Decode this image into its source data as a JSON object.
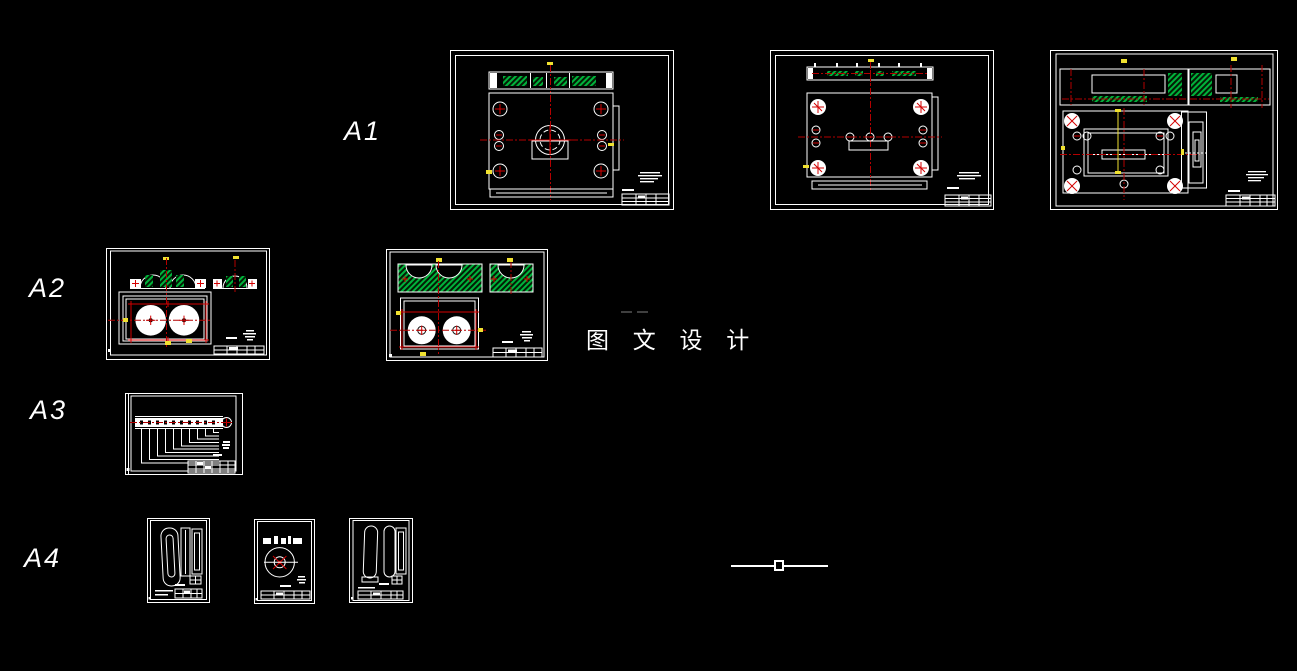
{
  "app": {
    "name": "cad-drawing-workspace",
    "background": "#000000"
  },
  "rows": [
    {
      "label": "A1",
      "sheet_count": 3
    },
    {
      "label": "A2",
      "sheet_count": 2
    },
    {
      "label": "A3",
      "sheet_count": 1
    },
    {
      "label": "A4",
      "sheet_count": 3
    }
  ],
  "watermark": {
    "text": "图 文 设 计"
  },
  "colors": {
    "background": "#000000",
    "paper_line": "#ffffff",
    "hatch_green": "#00b33c",
    "centerline_red": "#b40000",
    "marker_red": "#d40000",
    "dimension_yellow": "#f0e130",
    "faint_gray": "#3f3f3f"
  }
}
